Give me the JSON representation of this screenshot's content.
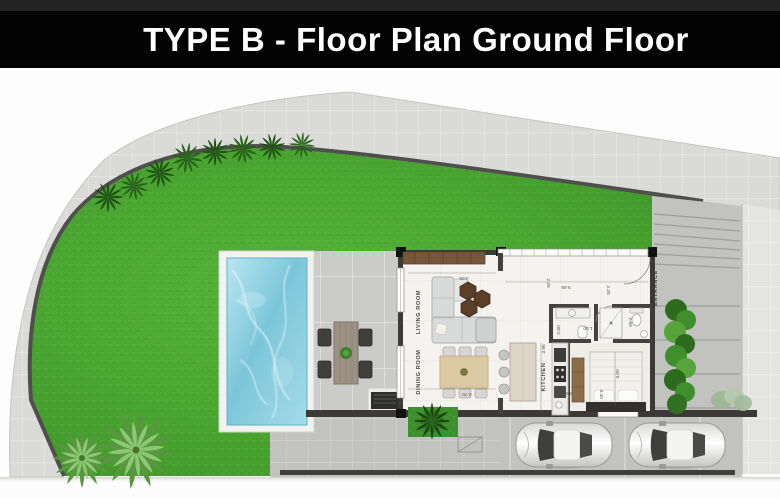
{
  "header": {
    "title": "TYPE B - Floor Plan Ground Floor"
  },
  "plan": {
    "rooms": [
      {
        "label": "LIVING ROOM"
      },
      {
        "label": "DINING ROOM"
      },
      {
        "label": "KITCHEN"
      },
      {
        "label": "MAIN"
      },
      {
        "label": "ENTRANCE"
      }
    ],
    "dimensions": [
      {
        "value": "4.05",
        "x": 464,
        "y": 277,
        "rot": 180
      },
      {
        "value": "4.70",
        "x": 467,
        "y": 393,
        "rot": 180
      },
      {
        "value": "5.65",
        "x": 566,
        "y": 286,
        "rot": 180
      },
      {
        "value": "2.25",
        "x": 547,
        "y": 283,
        "rot": 90
      },
      {
        "value": "2.25",
        "x": 607,
        "y": 290,
        "rot": 90
      },
      {
        "value": "3.96",
        "x": 545,
        "y": 349,
        "rot": -90
      },
      {
        "value": "2.60",
        "x": 629,
        "y": 322,
        "rot": 90
      },
      {
        "value": "1.00",
        "x": 588,
        "y": 327,
        "rot": 180
      },
      {
        "value": "0.60",
        "x": 560,
        "y": 330,
        "rot": -90
      },
      {
        "value": "3.00",
        "x": 619,
        "y": 374,
        "rot": -90
      },
      {
        "value": "3.40",
        "x": 600,
        "y": 394,
        "rot": 90
      },
      {
        "value": "0.60",
        "x": 568,
        "y": 392,
        "rot": 180
      }
    ],
    "colors": {
      "grass": "#4aa032",
      "pool_water": "#8ed2e4",
      "pavement": "#d9d9d7",
      "patio": "#c9c9c7",
      "wall": "#3c3a38",
      "wood": "#7a5b3a",
      "title_bg": "#000000",
      "title_text": "#ffffff"
    }
  }
}
